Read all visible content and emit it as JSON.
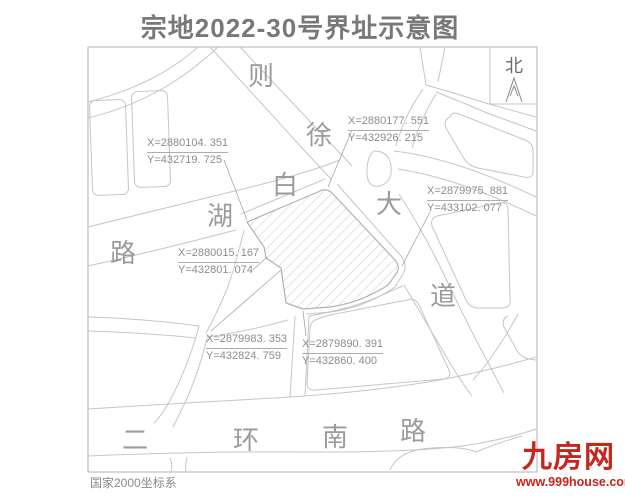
{
  "title": "宗地2022-30号界址示意图",
  "map_note": "国家2000坐标系",
  "north": {
    "label": "北"
  },
  "roads": {
    "zexu_dadao": {
      "name": "则徐大道",
      "chars": [
        "则",
        "徐",
        "大",
        "道"
      ]
    },
    "baihu_lu": {
      "name": "白湖路",
      "chars": [
        "白",
        "湖",
        "路"
      ]
    },
    "erhuan_nanlu": {
      "name": "二环南路",
      "chars": [
        "二",
        "环",
        "南",
        "路"
      ]
    }
  },
  "boundary_points": [
    {
      "x": "X=2880104. 351",
      "y": "Y=432719. 725"
    },
    {
      "x": "X=2880177. 551",
      "y": "Y=432926. 215"
    },
    {
      "x": "X=2879975. 881",
      "y": "Y=433102. 077"
    },
    {
      "x": "X=2880015. 167",
      "y": "Y=432801. 074"
    },
    {
      "x": "X=2879983. 353",
      "y": "Y=432824. 759"
    },
    {
      "x": "X=2879890. 391",
      "y": "Y=432860. 400"
    }
  ],
  "watermark": {
    "name": "九房网",
    "url": "www.999house.com"
  },
  "colors": {
    "road_line": "#c6c6c6",
    "parcel_line": "#b2b2b2",
    "hatch": "#cbcbcb",
    "label_text": "#8c8c8c",
    "title_text": "#787878",
    "logo_red": "#c5261f"
  }
}
